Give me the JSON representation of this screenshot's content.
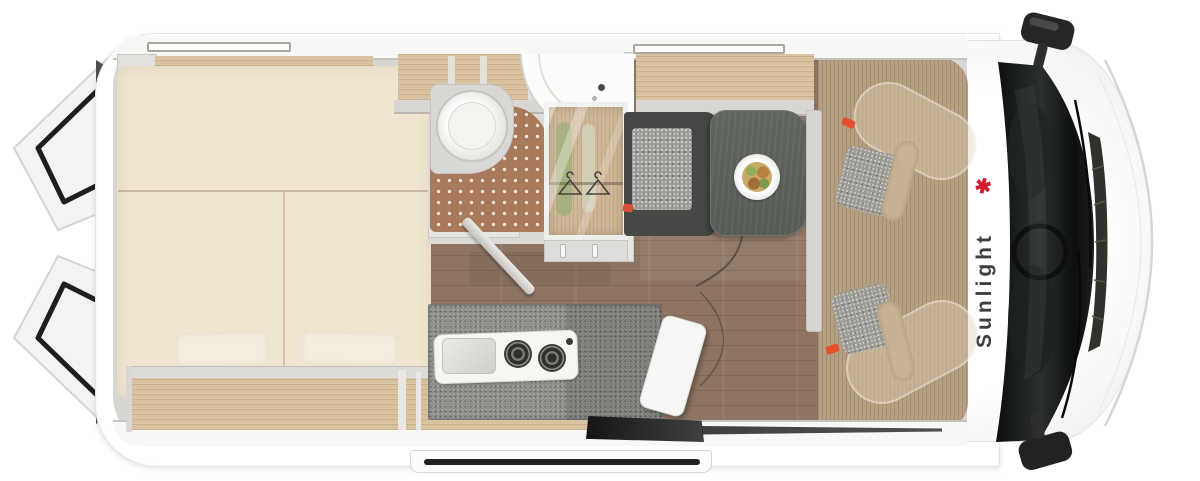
{
  "image_type": "campervan-floorplan-top-view",
  "brand": {
    "logo_text": "Sunlight",
    "palm_icon": "✱",
    "logo_text_color": "#3e3e3e",
    "logo_accent_color": "#cf1f2e"
  },
  "areas": {
    "rear_bed": "transverse rear bed with two pillows and storage shelves",
    "rear_doors": "two rear barn doors shown open",
    "bathroom": "wet room with toilet, shower mat and corner sink",
    "wardrobe": "glass-front wardrobe with hanging clothes",
    "kitchen": "kitchen block with sink, two-burner hob and cutting board",
    "dinette": "bench seat and pedestal table with plate of food",
    "entry": "open sliding door entry step",
    "cab": "driver cab with two swivel seats, windshield and mirrors"
  },
  "colors": {
    "body": "#ffffff",
    "interior_wall": "#d7d6d2",
    "wood_light": "#d8c19e",
    "floor_wood": "#8e7462",
    "cab_floor": "#b6a083",
    "mattress": "#f0e5d0",
    "shower_mat": "#a87a5b",
    "counter_granite": "#8d8f8a",
    "table_top": "#5f645f",
    "bench_frame": "#454845",
    "windshield": "#1a1d1c",
    "accent_red": "#d94f35"
  }
}
